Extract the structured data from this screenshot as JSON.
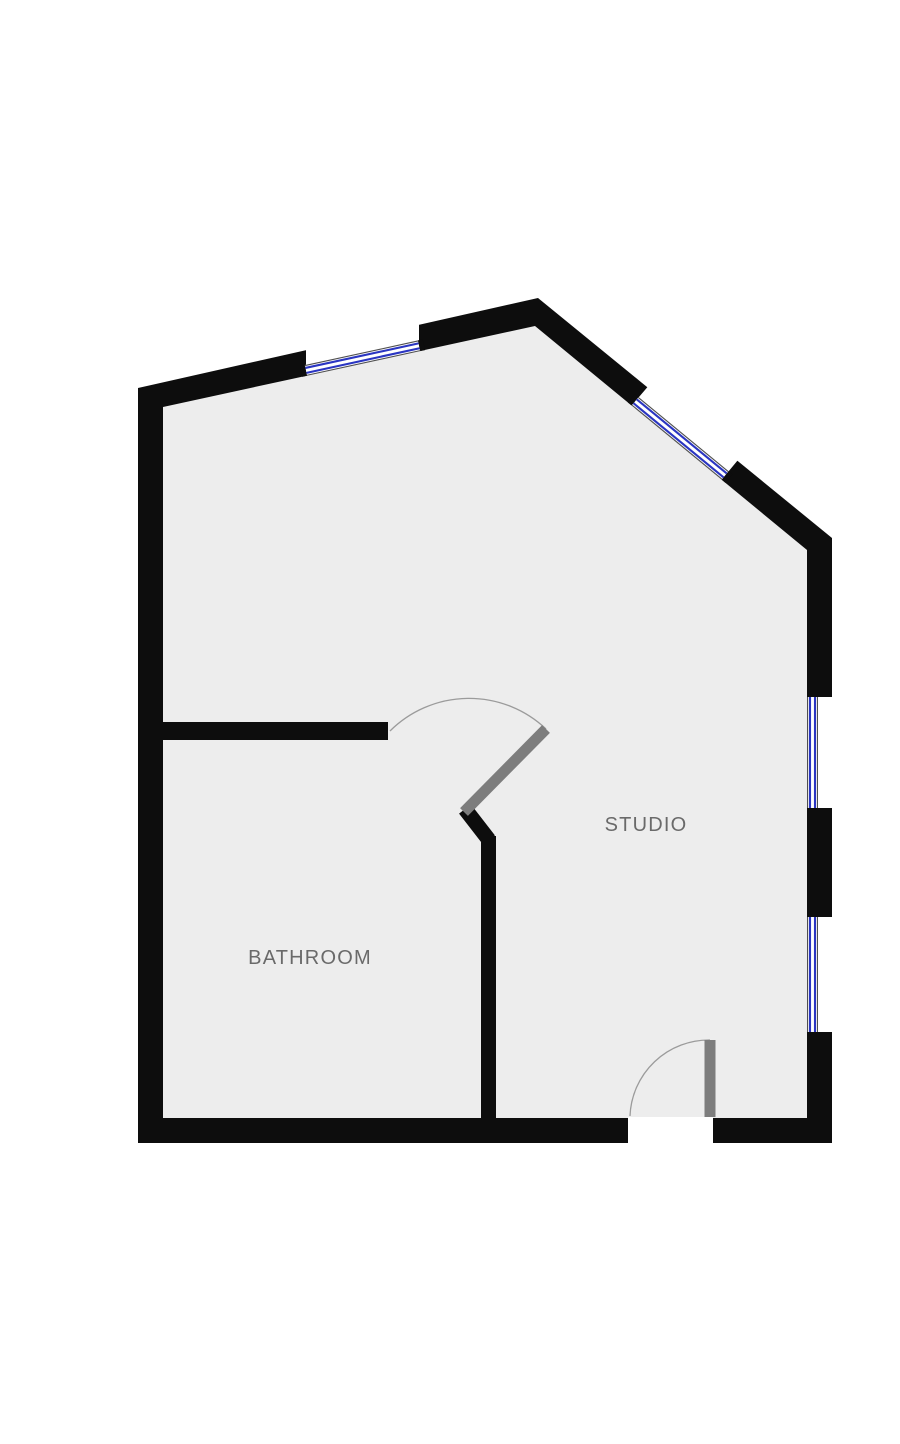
{
  "floorplan": {
    "canvas": {
      "width": 900,
      "height": 1444
    },
    "colors": {
      "background": "#ffffff",
      "wall": "#0d0d0d",
      "floor": "#ededed",
      "window_blue": "#2a35c2",
      "window_edge": "#4f4f4f",
      "door_leaf": "#7d7d7d",
      "door_arc": "#9b9b9b",
      "label": "#6a6a6a"
    },
    "label_style": {
      "size": 20,
      "letter_spacing": 1.2
    },
    "window_style": {
      "band_width": 11,
      "blue_offset": 2.5,
      "blue_width": 2.1,
      "edge_width": 1.1,
      "cap_length": 5
    },
    "rooms": [
      {
        "label": "STUDIO",
        "x": 646,
        "y": 831
      },
      {
        "label": "BATHROOM",
        "x": 310,
        "y": 964
      }
    ],
    "shapes": [
      {
        "type": "polygon",
        "name": "outer-wall",
        "points": [
          [
            138,
            388
          ],
          [
            538,
            298
          ],
          [
            832,
            538
          ],
          [
            832,
            1143
          ],
          [
            138,
            1143
          ]
        ],
        "fill": "wall"
      },
      {
        "type": "polygon",
        "name": "floor",
        "points": [
          [
            163,
            407
          ],
          [
            535,
            326
          ],
          [
            807,
            550
          ],
          [
            807,
            1118
          ],
          [
            163,
            1118
          ]
        ],
        "fill": "floor"
      },
      {
        "type": "polygon",
        "name": "window-gap-top",
        "points": [
          [
            306,
            348
          ],
          [
            419,
            322.6
          ],
          [
            419,
            351.3
          ],
          [
            306,
            375.9
          ]
        ],
        "fill": "background"
      },
      {
        "type": "polygon",
        "name": "window-gap-diagonal",
        "points": [
          [
            648.6,
            385.7
          ],
          [
            738.7,
            459.1
          ],
          [
            721.6,
            479.7
          ],
          [
            631.6,
            405.6
          ]
        ],
        "fill": "background"
      },
      {
        "type": "polygon",
        "name": "window-gap-right-upper",
        "points": [
          [
            807,
            697
          ],
          [
            836,
            697
          ],
          [
            836,
            808
          ],
          [
            807,
            808
          ]
        ],
        "fill": "background"
      },
      {
        "type": "polygon",
        "name": "window-gap-right-lower",
        "points": [
          [
            807,
            917
          ],
          [
            836,
            917
          ],
          [
            836,
            1032
          ],
          [
            807,
            1032
          ]
        ],
        "fill": "background"
      },
      {
        "type": "polygon",
        "name": "door-gap-entry",
        "points": [
          [
            628,
            1117
          ],
          [
            713,
            1117
          ],
          [
            713,
            1148
          ],
          [
            628,
            1148
          ]
        ],
        "fill": "background"
      },
      {
        "type": "window",
        "name": "window-top",
        "x1": 306,
        "y1": 370.4,
        "x2": 419,
        "y2": 345.8
      },
      {
        "type": "window",
        "name": "window-diagonal",
        "x1": 635.1,
        "y1": 401.3,
        "x2": 725.1,
        "y2": 475.4
      },
      {
        "type": "window",
        "name": "window-right-upper",
        "x1": 812.5,
        "y1": 697,
        "x2": 812.5,
        "y2": 808
      },
      {
        "type": "window",
        "name": "window-right-lower",
        "x1": 812.5,
        "y1": 917,
        "x2": 812.5,
        "y2": 1032
      },
      {
        "type": "rect",
        "name": "wall-bathroom-top",
        "x": 163,
        "y": 722,
        "w": 225,
        "h": 18,
        "fill": "wall"
      },
      {
        "type": "line",
        "name": "wall-bathroom-jog",
        "x1": 465,
        "y1": 809,
        "x2": 489,
        "y2": 840,
        "stroke": "wall",
        "width": 15
      },
      {
        "type": "rect",
        "name": "wall-bathroom-right",
        "x": 481,
        "y": 836,
        "w": 15,
        "h": 282,
        "fill": "wall"
      },
      {
        "type": "path",
        "name": "door-arc-bathroom",
        "d": "M 390 731 A 112 112 0 0 1 546 729",
        "stroke": "door_arc",
        "width": 1.3
      },
      {
        "type": "line",
        "name": "door-leaf-bathroom",
        "x1": 464,
        "y1": 812,
        "x2": 546,
        "y2": 729,
        "stroke": "door_leaf",
        "width": 11
      },
      {
        "type": "path",
        "name": "door-arc-entry",
        "d": "M 630 1116 A 79 79 0 0 1 710 1040",
        "stroke": "door_arc",
        "width": 1.3
      },
      {
        "type": "line",
        "name": "door-leaf-entry",
        "x1": 710,
        "y1": 1040,
        "x2": 710,
        "y2": 1117,
        "stroke": "door_leaf",
        "width": 11
      }
    ]
  }
}
